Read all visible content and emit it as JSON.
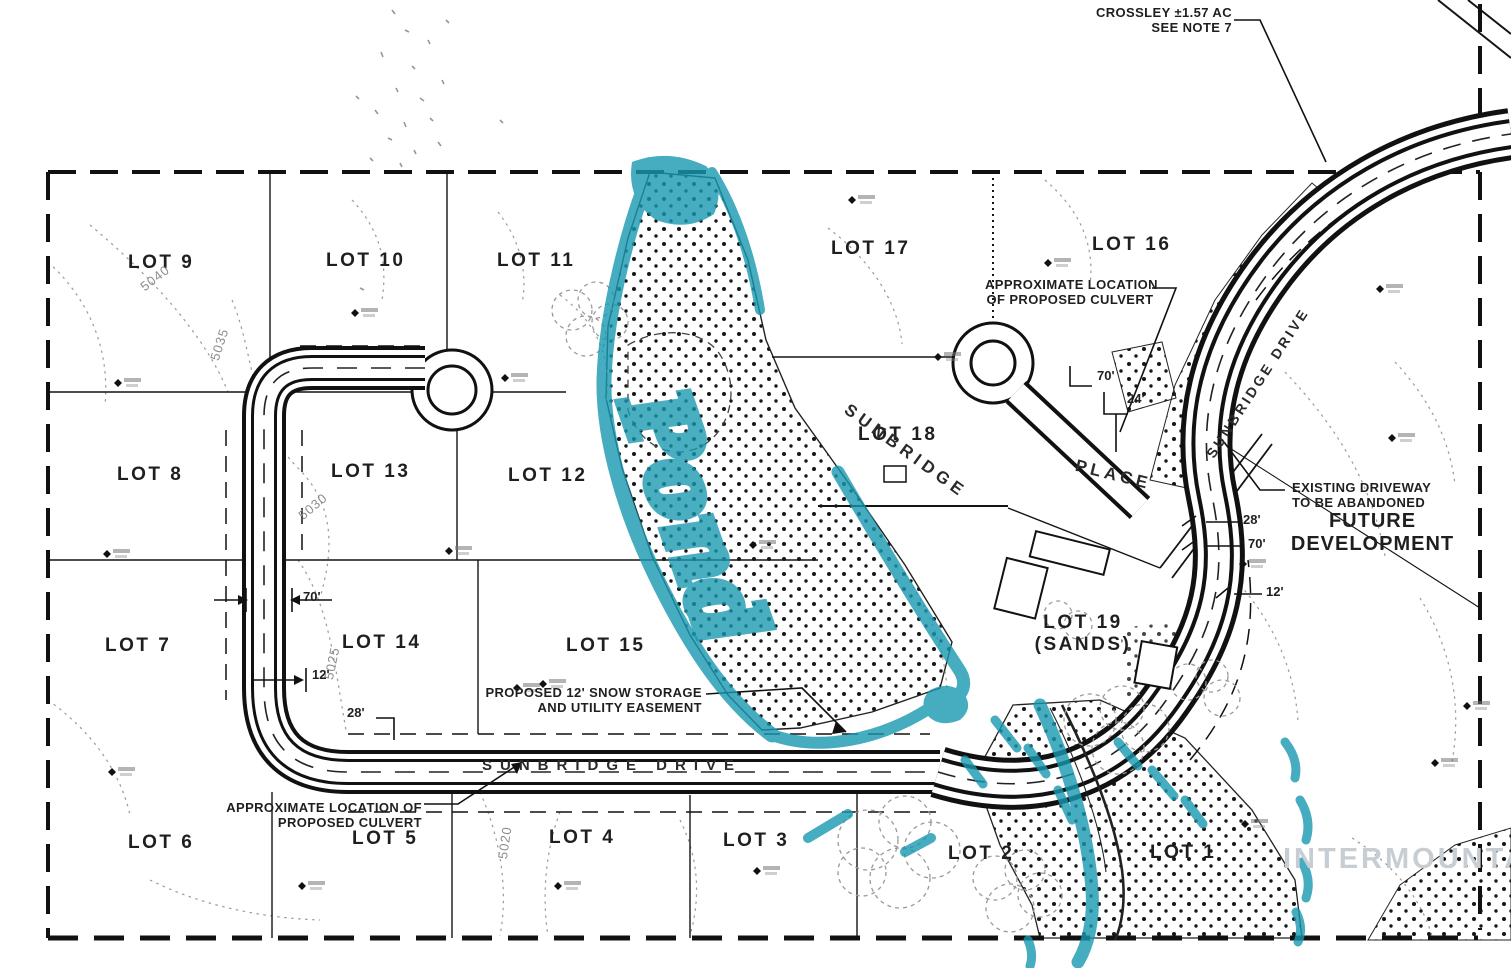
{
  "colors": {
    "line_black": "#141414",
    "highlight_teal": "#1898b0",
    "contour_gray": "#9a9a9a",
    "watermark_gray": "#c6ced3"
  },
  "lots": {
    "lot1": "LOT 1",
    "lot2": "LOT 2",
    "lot3": "LOT 3",
    "lot4": "LOT 4",
    "lot5": "LOT 5",
    "lot6": "LOT 6",
    "lot7": "LOT 7",
    "lot8": "LOT 8",
    "lot9": "LOT 9",
    "lot10": "LOT 10",
    "lot11": "LOT 11",
    "lot12": "LOT 12",
    "lot13": "LOT 13",
    "lot14": "LOT 14",
    "lot15": "LOT 15",
    "lot16": "LOT 16",
    "lot17": "LOT 17",
    "lot18": "LOT 18",
    "lot19_line1": "LOT 19",
    "lot19_line2": "(SANDS)"
  },
  "annotations": {
    "crossley_line1": "CROSSLEY ±1.57 AC",
    "crossley_line2": "SEE NOTE 7",
    "culvert_top_line1": "APPROXIMATE LOCATION",
    "culvert_top_line2": "OF PROPOSED CULVERT",
    "snow_line1": "PROPOSED 12' SNOW STORAGE",
    "snow_line2": "AND UTILITY EASEMENT",
    "culvert_bottom_line1": "APPROXIMATE LOCATION OF",
    "culvert_bottom_line2": "PROPOSED CULVERT",
    "driveway_line1": "EXISTING DRIVEWAY",
    "driveway_line2": "TO BE ABANDONED",
    "future_line1": "FUTURE",
    "future_line2": "DEVELOPMENT",
    "pond_handwriting": "Pond",
    "watermark": "INTERMOUNTAIN"
  },
  "roads": {
    "sunbridge_drive_bottom": "SUNBRIDGE DRIVE",
    "sunbridge_drive_right": "SUNBRIDGE DRIVE",
    "sunbridge_place_line1": "SUNBRIDGE",
    "sunbridge_place_line2": "PLACE"
  },
  "dimensions": {
    "left_70": "70'",
    "left_12": "12'",
    "left_28": "28'",
    "place_70": "70'",
    "place_24": "24'",
    "right_28": "28'",
    "right_70": "70'",
    "right_12": "12'"
  },
  "contours": {
    "c5040": "5040",
    "c5035": "5035",
    "c5030": "5030",
    "c5025": "5025",
    "c5020": "5020"
  }
}
